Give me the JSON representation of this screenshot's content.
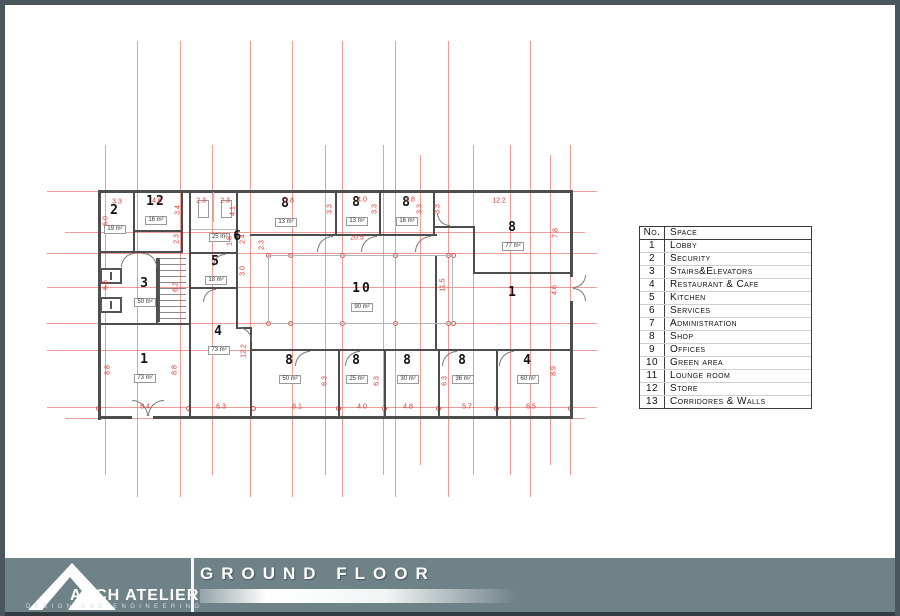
{
  "footer": {
    "title": "GROUND FLOOR",
    "brand": "ARCH ATELIER",
    "tagline": "DESIGN AND ENGINEERING",
    "band_color": "#6e8287",
    "frame_color": "#49565e"
  },
  "legend": {
    "header": {
      "no": "No.",
      "space": "Space"
    },
    "rows": [
      {
        "no": "1",
        "space": "Lobby"
      },
      {
        "no": "2",
        "space": "Security"
      },
      {
        "no": "3",
        "space": "Stairs&Elevators"
      },
      {
        "no": "4",
        "space": "Restaurant & Cafe"
      },
      {
        "no": "5",
        "space": "Kitchen"
      },
      {
        "no": "6",
        "space": "Services"
      },
      {
        "no": "7",
        "space": "Administration"
      },
      {
        "no": "8",
        "space": "Shop"
      },
      {
        "no": "9",
        "space": "Offices"
      },
      {
        "no": "10",
        "space": "Green area"
      },
      {
        "no": "11",
        "space": "Lounge room"
      },
      {
        "no": "12",
        "space": "Store"
      },
      {
        "no": "13",
        "space": "Corridores & Walls"
      }
    ]
  },
  "plan": {
    "dim_color": "#d8382e",
    "wall_color": "#4d4d4d",
    "grid": {
      "v": [
        [
          132,
          36,
          492
        ],
        [
          175,
          36,
          492
        ],
        [
          245,
          36,
          492
        ],
        [
          287,
          36,
          492
        ],
        [
          337,
          36,
          492
        ],
        [
          390,
          36,
          492
        ],
        [
          443,
          36,
          492
        ],
        [
          525,
          36,
          492
        ],
        [
          100,
          140,
          470
        ],
        [
          207,
          140,
          470
        ],
        [
          320,
          140,
          470
        ],
        [
          378,
          140,
          470
        ],
        [
          415,
          150,
          460
        ],
        [
          468,
          140,
          470
        ],
        [
          505,
          140,
          470
        ],
        [
          545,
          150,
          460
        ],
        [
          565,
          140,
          470
        ]
      ],
      "h": [
        [
          186,
          42,
          592
        ],
        [
          227,
          60,
          580
        ],
        [
          248,
          42,
          592
        ],
        [
          282,
          42,
          592
        ],
        [
          318,
          42,
          592
        ],
        [
          345,
          42,
          592
        ],
        [
          402,
          42,
          592
        ],
        [
          413,
          60,
          580
        ]
      ],
      "circles": [
        [
          263,
          250
        ],
        [
          285,
          250
        ],
        [
          337,
          250
        ],
        [
          390,
          250
        ],
        [
          443,
          250
        ],
        [
          448,
          250
        ],
        [
          263,
          318
        ],
        [
          285,
          318
        ],
        [
          337,
          318
        ],
        [
          390,
          318
        ],
        [
          443,
          318
        ],
        [
          448,
          318
        ],
        [
          93,
          403
        ],
        [
          183,
          403
        ],
        [
          248,
          403
        ],
        [
          333,
          403
        ],
        [
          379,
          403
        ],
        [
          433,
          403
        ],
        [
          491,
          403
        ],
        [
          565,
          403
        ]
      ]
    },
    "walls": [
      [
        93,
        185,
        475,
        3
      ],
      [
        93,
        185,
        3,
        230
      ],
      [
        565,
        185,
        3,
        87
      ],
      [
        565,
        296,
        3,
        117
      ],
      [
        93,
        411,
        34,
        3
      ],
      [
        148,
        411,
        420,
        3
      ],
      [
        128,
        185,
        2,
        63
      ],
      [
        176,
        185,
        2,
        63
      ],
      [
        93,
        246,
        85,
        2
      ],
      [
        128,
        225,
        50,
        2
      ],
      [
        184,
        185,
        2,
        228
      ],
      [
        231,
        185,
        2,
        99
      ],
      [
        184,
        247,
        49,
        2
      ],
      [
        184,
        282,
        49,
        2
      ],
      [
        93,
        318,
        93,
        2
      ],
      [
        151,
        253,
        2,
        65
      ],
      [
        245,
        229,
        187,
        2
      ],
      [
        330,
        185,
        2,
        45
      ],
      [
        374,
        185,
        2,
        45
      ],
      [
        428,
        185,
        2,
        45
      ],
      [
        430,
        221,
        40,
        2
      ],
      [
        468,
        221,
        2,
        48
      ],
      [
        468,
        267,
        100,
        2
      ],
      [
        430,
        250,
        2,
        96
      ],
      [
        430,
        344,
        138,
        2
      ],
      [
        245,
        344,
        187,
        2
      ],
      [
        333,
        346,
        2,
        65
      ],
      [
        379,
        346,
        2,
        65
      ],
      [
        433,
        346,
        2,
        65
      ],
      [
        491,
        346,
        2,
        65
      ],
      [
        231,
        284,
        2,
        40
      ],
      [
        231,
        322,
        16,
        2
      ],
      [
        245,
        324,
        2,
        89
      ]
    ],
    "thin_lines": [
      [
        263,
        250,
        185,
        1
      ],
      [
        263,
        318,
        185,
        1
      ],
      [
        263,
        250,
        1,
        68
      ],
      [
        447,
        250,
        1,
        68
      ],
      [
        320,
        250,
        1,
        68
      ],
      [
        378,
        250,
        1,
        68
      ],
      [
        208,
        187,
        1,
        30
      ],
      [
        186,
        224,
        45,
        1
      ]
    ],
    "fixtures": [
      [
        193,
        195,
        9,
        16
      ],
      [
        216,
        195,
        9,
        16
      ]
    ],
    "elevators": [
      [
        95,
        263,
        22,
        16
      ],
      [
        95,
        292,
        22,
        16
      ]
    ],
    "stairs": [
      153,
      253,
      26,
      64
    ],
    "doors": [
      [
        116,
        248,
        14,
        "tl"
      ],
      [
        138,
        248,
        14,
        "tr"
      ],
      [
        198,
        284,
        13,
        "tl"
      ],
      [
        208,
        249,
        12,
        "tl"
      ],
      [
        312,
        231,
        16,
        "tl"
      ],
      [
        356,
        231,
        16,
        "tl"
      ],
      [
        410,
        231,
        16,
        "tl"
      ],
      [
        432,
        208,
        13,
        "bl"
      ],
      [
        233,
        322,
        14,
        "tr"
      ],
      [
        290,
        346,
        15,
        "tl"
      ],
      [
        340,
        346,
        15,
        "tl"
      ],
      [
        437,
        346,
        15,
        "tl"
      ],
      [
        494,
        346,
        15,
        "tl"
      ],
      [
        127,
        395,
        16,
        "tr"
      ],
      [
        143,
        395,
        16,
        "tl"
      ],
      [
        568,
        270,
        13,
        "br"
      ],
      [
        568,
        283,
        13,
        "tr"
      ]
    ],
    "rooms": [
      {
        "num": "2",
        "area": "19 m²",
        "x": 110,
        "y": 206
      },
      {
        "num": "12",
        "area": "16 m²",
        "x": 151,
        "y": 197
      },
      {
        "num": "6",
        "area": "25 m²",
        "x": 221,
        "y": 232,
        "side": "left"
      },
      {
        "num": "5",
        "area": "18 m²",
        "x": 211,
        "y": 257
      },
      {
        "num": "8",
        "area": "13 m²",
        "x": 281,
        "y": 199
      },
      {
        "num": "8",
        "area": "13 m²",
        "x": 352,
        "y": 198
      },
      {
        "num": "8",
        "area": "16 m²",
        "x": 402,
        "y": 198
      },
      {
        "num": "8",
        "area": "77 m²",
        "x": 508,
        "y": 223
      },
      {
        "num": "1",
        "x": 508,
        "y": 288
      },
      {
        "num": "10",
        "area": "90 m²",
        "x": 357,
        "y": 284
      },
      {
        "num": "3",
        "area": "50 m²",
        "x": 140,
        "y": 279
      },
      {
        "num": "4",
        "area": "73 m²",
        "x": 214,
        "y": 327
      },
      {
        "num": "1",
        "area": "73 m²",
        "x": 140,
        "y": 355
      },
      {
        "num": "8",
        "area": "50 m²",
        "x": 285,
        "y": 356
      },
      {
        "num": "8",
        "area": "25 m²",
        "x": 352,
        "y": 356
      },
      {
        "num": "8",
        "area": "30 m²",
        "x": 403,
        "y": 356
      },
      {
        "num": "8",
        "area": "36 m²",
        "x": 458,
        "y": 356
      },
      {
        "num": "4",
        "area": "60 m²",
        "x": 523,
        "y": 356
      }
    ],
    "dims": [
      {
        "t": "3.3",
        "x": 112,
        "y": 197
      },
      {
        "t": "4.6",
        "x": 152,
        "y": 196
      },
      {
        "t": "2.3",
        "x": 196,
        "y": 196
      },
      {
        "t": "2.3",
        "x": 220,
        "y": 196
      },
      {
        "t": "3.8",
        "x": 284,
        "y": 196
      },
      {
        "t": "4.0",
        "x": 357,
        "y": 195
      },
      {
        "t": "4.8",
        "x": 405,
        "y": 195
      },
      {
        "t": "12.2",
        "x": 494,
        "y": 196
      },
      {
        "t": "20.5",
        "x": 352,
        "y": 233
      },
      {
        "t": "6.0",
        "x": 101,
        "y": 216,
        "r": 1
      },
      {
        "t": "3.4",
        "x": 173,
        "y": 205,
        "r": 1
      },
      {
        "t": "2.3",
        "x": 172,
        "y": 234,
        "r": 1
      },
      {
        "t": "4.1",
        "x": 228,
        "y": 206,
        "r": 1
      },
      {
        "t": "1.8",
        "x": 225,
        "y": 236,
        "r": 1
      },
      {
        "t": "2.4",
        "x": 238,
        "y": 234,
        "r": 1
      },
      {
        "t": "3.0",
        "x": 238,
        "y": 266,
        "r": 1
      },
      {
        "t": "2.3",
        "x": 257,
        "y": 240,
        "r": 1
      },
      {
        "t": "3.3",
        "x": 325,
        "y": 204,
        "r": 1
      },
      {
        "t": "3.3",
        "x": 370,
        "y": 204,
        "r": 1
      },
      {
        "t": "3.3",
        "x": 415,
        "y": 204,
        "r": 1
      },
      {
        "t": "3.3",
        "x": 433,
        "y": 204,
        "r": 1
      },
      {
        "t": "7.8",
        "x": 551,
        "y": 228,
        "r": 1
      },
      {
        "t": "11.5",
        "x": 438,
        "y": 280,
        "r": 1
      },
      {
        "t": "4.6",
        "x": 550,
        "y": 285,
        "r": 1
      },
      {
        "t": "6.6",
        "x": 101,
        "y": 280,
        "r": 1
      },
      {
        "t": "6.2",
        "x": 171,
        "y": 282,
        "r": 1
      },
      {
        "t": "12.2",
        "x": 239,
        "y": 346,
        "r": 1
      },
      {
        "t": "8.8",
        "x": 103,
        "y": 365,
        "r": 1
      },
      {
        "t": "8.8",
        "x": 170,
        "y": 365,
        "r": 1
      },
      {
        "t": "6.3",
        "x": 320,
        "y": 376,
        "r": 1
      },
      {
        "t": "6.3",
        "x": 372,
        "y": 376,
        "r": 1
      },
      {
        "t": "6.3",
        "x": 440,
        "y": 376,
        "r": 1
      },
      {
        "t": "8.9",
        "x": 549,
        "y": 366,
        "r": 1
      },
      {
        "t": "8.4",
        "x": 140,
        "y": 402
      },
      {
        "t": "6.3",
        "x": 216,
        "y": 402
      },
      {
        "t": "8.1",
        "x": 292,
        "y": 402
      },
      {
        "t": "4.0",
        "x": 357,
        "y": 402
      },
      {
        "t": "4.8",
        "x": 403,
        "y": 402
      },
      {
        "t": "5.7",
        "x": 462,
        "y": 402
      },
      {
        "t": "6.5",
        "x": 526,
        "y": 402
      }
    ]
  }
}
